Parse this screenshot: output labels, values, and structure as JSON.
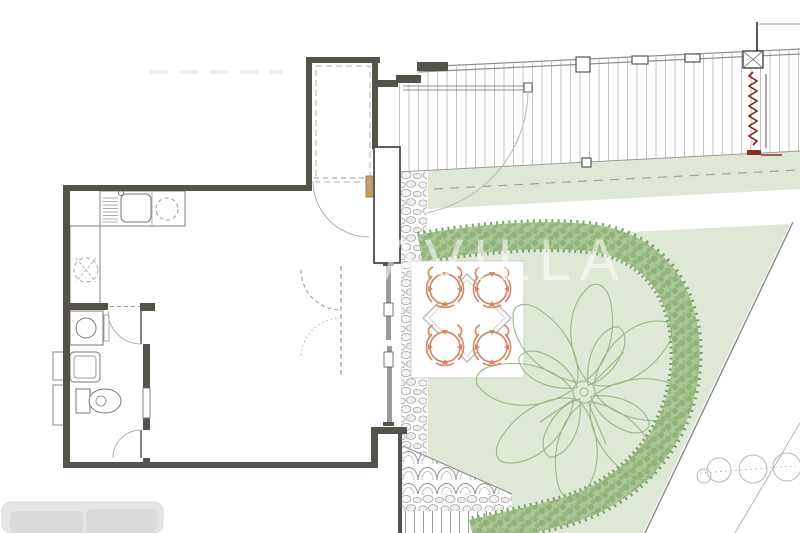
{
  "watermark": {
    "text": "LAVILLA"
  },
  "colors": {
    "wall": "#55524c",
    "lawn": "#dfe8d7",
    "hedge_base": "#aac695",
    "hedge_edge": "#6f9a5c",
    "tree": "#8fb478",
    "chair": "#d28a68",
    "front_door": "#c49a6c",
    "stair_red": "#7c281e",
    "deck_line": "#bdbdbd",
    "stone": "#a3a3a3",
    "sofa": "#e6e6e6"
  }
}
